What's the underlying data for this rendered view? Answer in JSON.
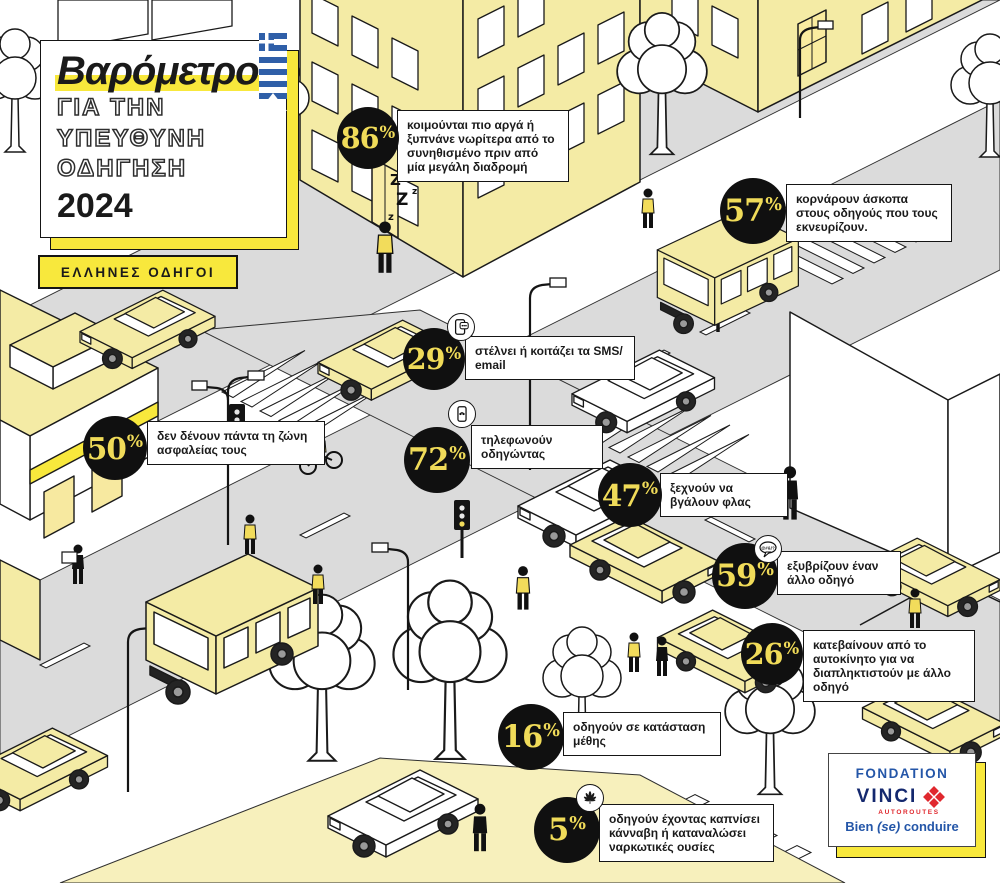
{
  "chart_data": {
    "type": "table",
    "title": "Βαρόμετρο για την υπεύθυνη οδήγηση 2024 — Έλληνες οδηγοί",
    "columns": [
      "ποσοστό",
      "συμπεριφορά"
    ],
    "rows": [
      [
        "86%",
        "κοιμούνται πιο αργά ή ξυπνάνε νωρίτερα από το συνηθισμένο πριν από μία μεγάλη διαδρομή"
      ],
      [
        "57%",
        "κορνάρουν άσκοπα στους οδηγούς που τους εκνευρίζουν."
      ],
      [
        "29%",
        "στέλνει ή κοιτάζει τα SMS/email"
      ],
      [
        "72%",
        "τηλεφωνούν οδηγώντας"
      ],
      [
        "50%",
        "δεν δένουν πάντα τη ζώνη ασφαλείας τους"
      ],
      [
        "47%",
        "ξεχνούν να βγάλουν φλας"
      ],
      [
        "59%",
        "εξυβρίζουν έναν άλλο οδηγό"
      ],
      [
        "26%",
        "κατεβαίνουν από το αυτοκίνητο για να διαπληκτιστούν με άλλο οδηγό"
      ],
      [
        "16%",
        "οδηγούν σε κατάσταση μέθης"
      ],
      [
        "5%",
        "οδηγούν έχοντας καπνίσει κάνναβη ή καταναλώσει ναρκωτικές ουσίες"
      ]
    ]
  },
  "title": {
    "line1": "Βαρόμετρο",
    "line2": "ΓΙΑ ΤΗΝ",
    "line3": "ΥΠΕΥΘΥΝΗ",
    "line4": "ΟΔΗΓΗΣΗ",
    "year": "2024"
  },
  "badge": "ΕΛΛΗΝΕΣ ΟΔΗΓΟΙ",
  "stats": [
    {
      "value": "86",
      "suffix": "%",
      "label": "κοιμούνται πιο αργά ή ξυπνάνε νωρίτερα από το συνηθισμένο πριν από μία μεγάλη διαδρομή",
      "icon": ""
    },
    {
      "value": "57",
      "suffix": "%",
      "label": "κορνάρουν άσκοπα στους οδηγούς που τους εκνευρίζουν.",
      "icon": ""
    },
    {
      "value": "29",
      "suffix": "%",
      "label": "στέλνει ή κοιτάζει τα SMS/ email",
      "icon": "sms-icon"
    },
    {
      "value": "72",
      "suffix": "%",
      "label": "τηλεφωνούν οδηγώντας",
      "icon": "phone-icon"
    },
    {
      "value": "50",
      "suffix": "%",
      "label": "δεν δένουν πάντα τη ζώνη ασφαλείας τους",
      "icon": ""
    },
    {
      "value": "47",
      "suffix": "%",
      "label": "ξεχνούν να βγάλουν φλας",
      "icon": ""
    },
    {
      "value": "59",
      "suffix": "%",
      "label": "εξυβρίζουν έναν άλλο οδηγό",
      "icon": "curse-bubble-icon"
    },
    {
      "value": "26",
      "suffix": "%",
      "label": "κατεβαίνουν από το αυτοκίνητο για να διαπληκτιστούν με άλλο οδηγό",
      "icon": ""
    },
    {
      "value": "16",
      "suffix": "%",
      "label": "οδηγούν σε κατάσταση μέθης",
      "icon": ""
    },
    {
      "value": "5",
      "suffix": "%",
      "label": "οδηγούν έχοντας καπνίσει κάνναβη ή καταναλώσει ναρκωτικές ουσίες",
      "icon": "cannabis-icon"
    }
  ],
  "logo": {
    "fondation": "FONDATION",
    "brand": "VINCI",
    "autoroutes": "AUTOROUTES",
    "tagline_pre": "Bien ",
    "tagline_italic": "(se)",
    "tagline_post": " conduire"
  },
  "scene": {
    "zzz1": "Z",
    "zzz2": "z",
    "zzz3": "Z",
    "zzz4": "z",
    "zzz5": "z",
    "curse": "@#&!?"
  },
  "colors": {
    "accent_yellow": "#F8E83C",
    "pale_yellow": "#F4EBA5",
    "road_gray": "#DBDBDB",
    "circle_black": "#101010",
    "number_yellow": "#F0DB59",
    "logo_blue": "#2456A8",
    "logo_navy": "#14286E",
    "logo_red": "#E0282E",
    "flag_blue": "#2F5FA8"
  }
}
